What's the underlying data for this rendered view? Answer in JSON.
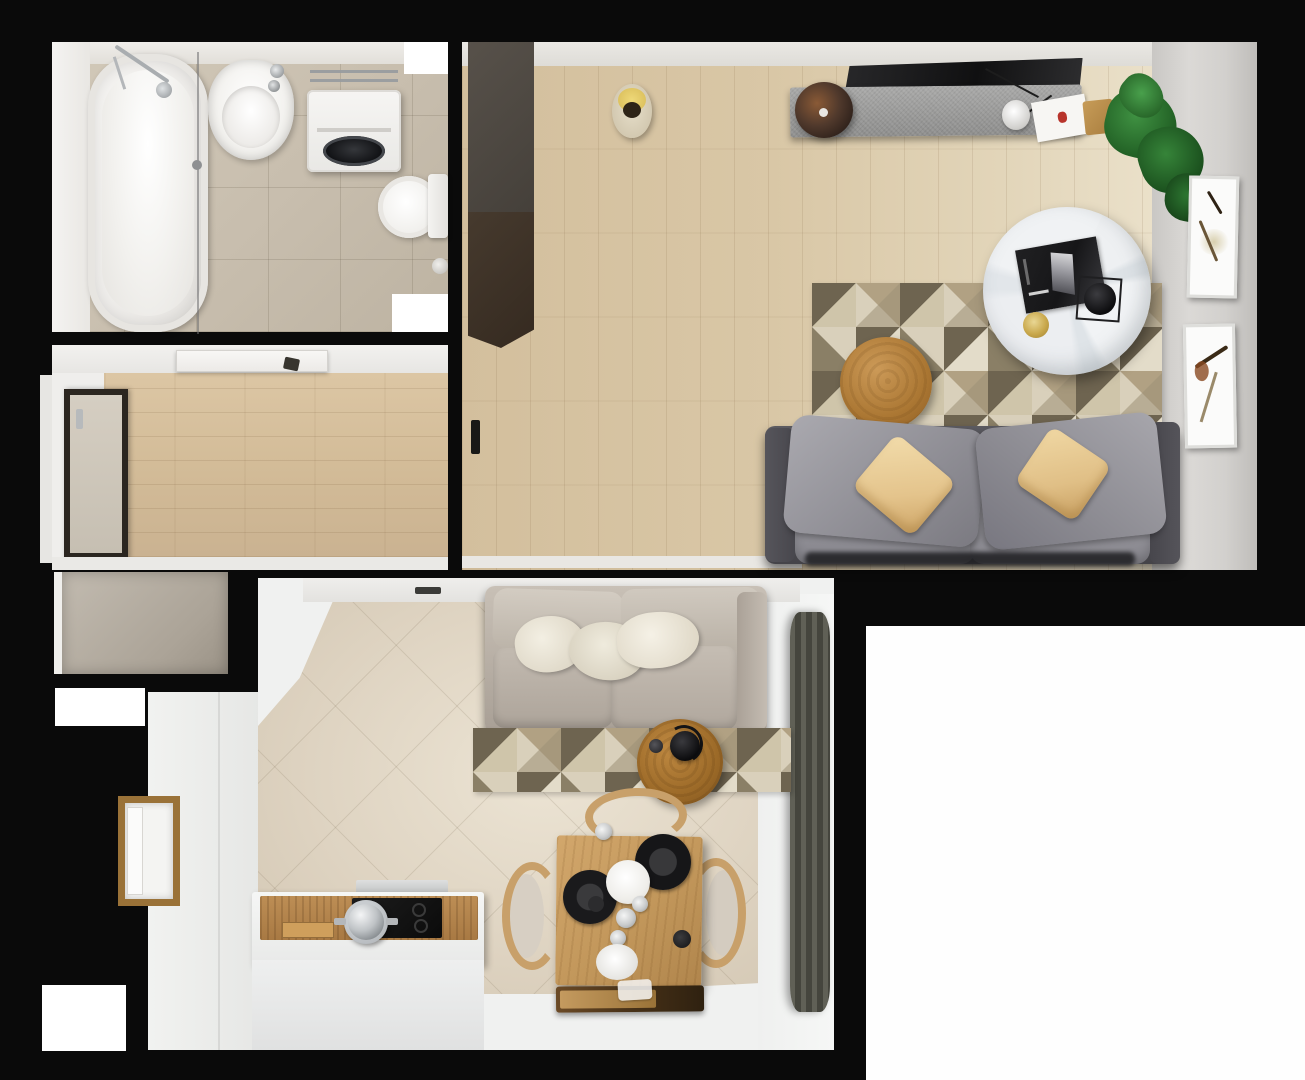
{
  "meta": {
    "title": "Top-down 3D render of a one-bedroom apartment interior",
    "view": "bird's-eye / floor-plan render",
    "visible_text": "none"
  },
  "palette": {
    "black": "#0a0a0a",
    "wall_white": "#f1f0ee",
    "wall_gray": "#d5d3d0",
    "bath_tile": "#c8beae",
    "bath_tile_light": "#d2c9b9",
    "fixture_white": "#f6f5f3",
    "chrome": "#b9bcbe",
    "wood_hall": "#d2bb97",
    "wood_living": "#d9c7a6",
    "wardrobe_dark": "#3b2f26",
    "desk_gray": "#9e9e9d",
    "tv_black": "#1b1b1c",
    "lamp_copper": "#7c4526",
    "plant_green": "#2f7a2f",
    "marble_white": "#eceff1",
    "gold": "#c9a84c",
    "rug_cream": "#d9d0bb",
    "rug_tan": "#b1a183",
    "rug_olive": "#6e6450",
    "oak": "#ab7733",
    "sofa_gray": "#98979d",
    "sofa_frame": "#4b4a50",
    "pillow_yellow": "#e9cb92",
    "sofa2_beige": "#b9b0a5",
    "pillow_cream": "#e9e4d5",
    "tile_diag": "#ded3c1",
    "curtain_olive": "#54544a",
    "table_wood": "#c59a5f",
    "chair_wood": "#c8a06a",
    "counter_wood": "#b2824b",
    "cooktop_black": "#141414",
    "white_floor": "#f2f3f2",
    "pure_white": "#ffffff"
  },
  "scene": {
    "rooms": [
      {
        "name": "bathroom",
        "position": "top-left",
        "floor": "beige ceramic tile",
        "objects": [
          "bathtub with glass shower screen",
          "chrome shower set",
          "white washbasin with chrome taps",
          "washing machine with chrome piping",
          "toilet with tank"
        ]
      },
      {
        "name": "hallway",
        "position": "middle-left",
        "floor": "light oak planks (horizontal)",
        "objects": [
          "open white entry door with dark handle",
          "dark-framed balcony/glass door"
        ]
      },
      {
        "name": "living-room",
        "position": "right",
        "floor": "light oak planks",
        "objects": [
          "tall dark wardrobe",
          "beige basket with yellow blanket",
          "black tv/shelf panel",
          "gray speckled console desk",
          "copper dome lamp",
          "white desk lamp with wire",
          "paper sheet with red accent",
          "wooden cutting board",
          "green potted plant",
          "geometric triangle rug",
          "round marble coffee table",
          "black magazine",
          "gold candle",
          "black bowl in wire holder",
          "round oak side table",
          "gray fabric sofa with two yellow pillows",
          "two abstract wall-art frames on right wall",
          "black door handle on left wall"
        ]
      },
      {
        "name": "kitchen-dining-room",
        "position": "bottom-center",
        "floor": "beige diagonal tile + white screed",
        "objects": [
          "gray-beige storage closet",
          "entry nook with wood-trimmed doorway",
          "beige two-seat sofa with cream pillows",
          "geometric triangle rug",
          "round oak coffee table with black kettle and cup",
          "square oak dining table",
          "three bentwood chairs",
          "two black plates",
          "white bowl",
          "glasses and small dishes",
          "dark wood bench tray",
          "white kitchen counter with wood backsplash",
          "black induction cooktop",
          "steel pot",
          "extractor strip",
          "olive floor-length curtain"
        ]
      }
    ],
    "openings": [
      "white wall niche top-center",
      "white wall niche mid-left of living wall",
      "white window gap left wall (hall)",
      "white window gap left wall (entry)",
      "white window gap bottom-left"
    ],
    "empty_area": "large white rectangle bottom-right (outside apartment)"
  }
}
